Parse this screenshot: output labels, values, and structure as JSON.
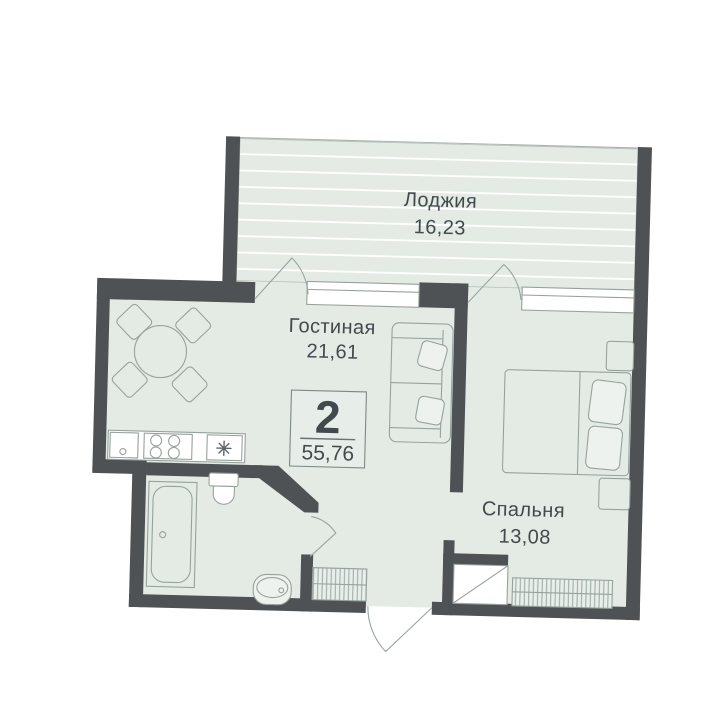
{
  "plan": {
    "badge": {
      "rooms_count": "2",
      "total_area": "55,76"
    },
    "rooms": [
      {
        "id": "loggia",
        "name": "Лоджия",
        "area": "16,23"
      },
      {
        "id": "living-room",
        "name": "Гостиная",
        "area": "21,61"
      },
      {
        "id": "bedroom",
        "name": "Спальня",
        "area": "13,08"
      }
    ],
    "colors": {
      "wall": "#4f5254",
      "floor": "#e4ebe5",
      "loggia_stripe": "#ffffff",
      "furniture_outline": "#97a29c",
      "window": "#ffffff",
      "text": "#424a4e",
      "badge_border": "#7c8984"
    }
  }
}
